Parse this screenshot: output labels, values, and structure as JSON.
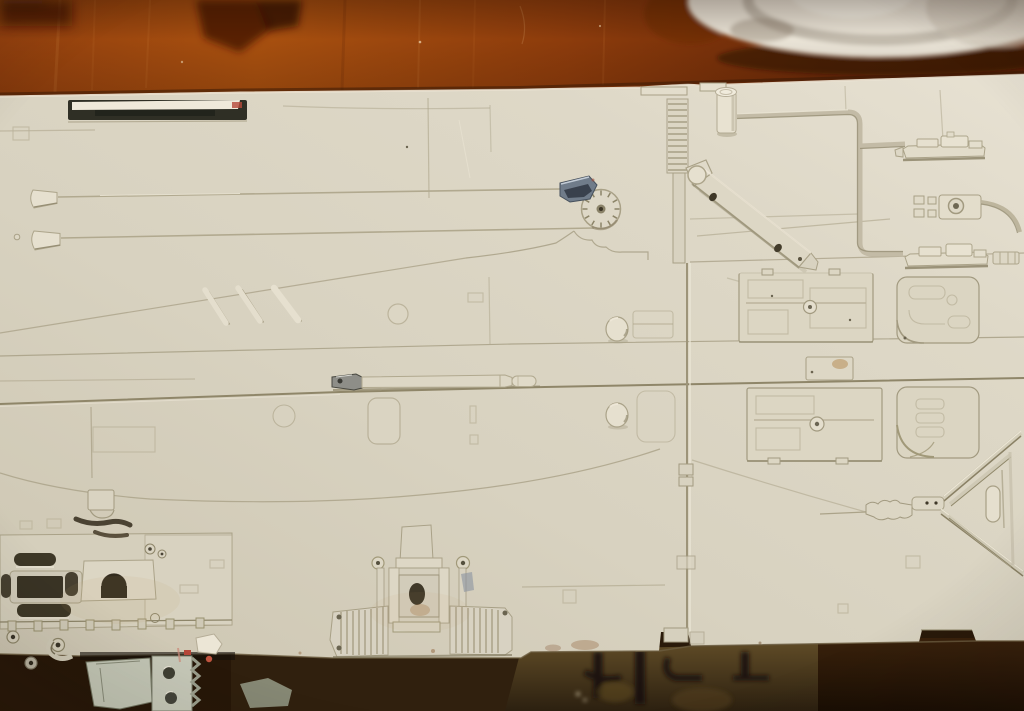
{
  "image": {
    "type": "photograph",
    "subject": "Large off-white studio scale model hull panel covered with mechanical greeblies",
    "surface": "reddish-brown wooden tabletop",
    "background_objects": [
      "blurred white dish at top right",
      "dark blurred furniture leg at top left",
      "dark under-table shadow with blurred machinery below the panel"
    ],
    "notable_details": [
      "recessed dark slot at upper left",
      "two long antenna rods with conical bases",
      "three short diagonal slash strips",
      "clock-like tick dial with blue-grey wedge greeblie",
      "vertical ribbed ladder strip and long panel divider",
      "diagonal strut arm with two dark holes",
      "raised pipe run feeding three battleship-shaped greeblies",
      "four rectangular detail boxes with knobs and slats",
      "Y-shaped truss frame with small cylinder",
      "ribbed engine cluster at lower left with dark slots",
      "T-shaped ribbed assembly at bottom center",
      "grey machinery hanging below the panel edge"
    ],
    "text_visible": "none"
  },
  "colors": {
    "wood_light": "#a8500f",
    "wood_mid": "#8d3c0c",
    "wood_dark": "#5a2206",
    "plate_white": "#eae4d7",
    "panel_light": "#e7e1d2",
    "panel_mid": "#d8d2c0",
    "panel_dark": "#cdc6b2",
    "line_soft": "#aba389",
    "line_shadow": "#968e74",
    "recess_dark": "#3c3526",
    "wedge_grey": "#707c8a",
    "machinery_grey": "#c2c5b4",
    "under_olive": "#5e4a26",
    "under_brown": "#2a1a0a",
    "accent_red": "#b5483a"
  }
}
